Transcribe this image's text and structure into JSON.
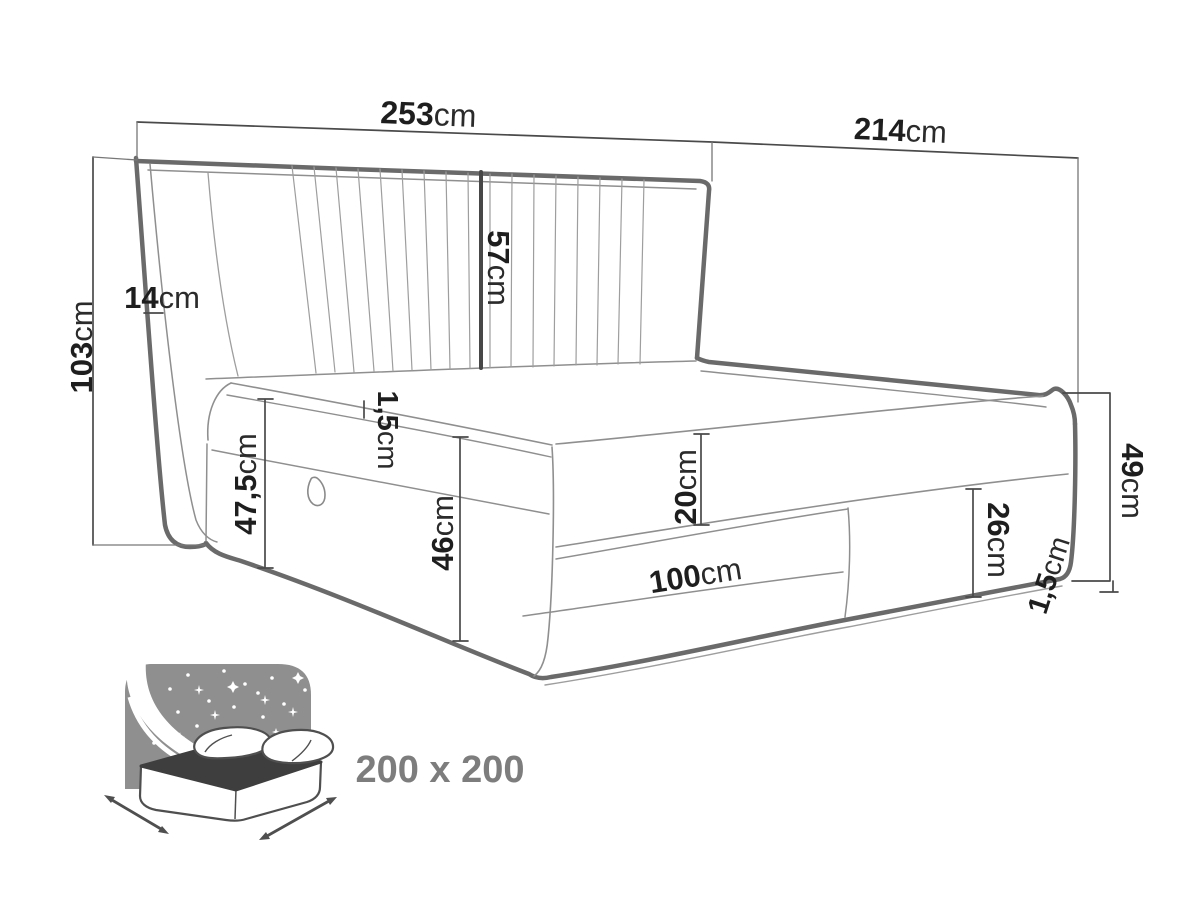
{
  "diagram": {
    "dimensions": {
      "total_width": {
        "value": "253",
        "unit": "cm"
      },
      "total_depth": {
        "value": "214",
        "unit": "cm"
      },
      "headboard_height": {
        "value": "103",
        "unit": "cm"
      },
      "wing_thickness": {
        "value": "14",
        "unit": "cm"
      },
      "headboard_above_mattress": {
        "value": "57",
        "unit": "cm"
      },
      "mattress_seam": {
        "value": "1,5",
        "unit": "cm"
      },
      "side_height": {
        "value": "47,5",
        "unit": "cm"
      },
      "storage_box_height": {
        "value": "46",
        "unit": "cm"
      },
      "mattress_height": {
        "value": "20",
        "unit": "cm"
      },
      "drawer_width": {
        "value": "100",
        "unit": "cm"
      },
      "foot_panel_height": {
        "value": "26",
        "unit": "cm"
      },
      "foot_corner_height": {
        "value": "49",
        "unit": "cm"
      },
      "base_trim": {
        "value": "1,5",
        "unit": "cm"
      }
    },
    "size_badge": {
      "label": "200 x 200"
    },
    "colors": {
      "outline_thick": "#6a6a6a",
      "outline_thin": "#8f8f8f",
      "dimension_line": "#4a4a4a",
      "label_text": "#1e1e1e",
      "icon_gray": "#8f8f8f",
      "icon_mattress_dark": "#3e3e3e",
      "badge_text": "#7d7d7d"
    }
  }
}
